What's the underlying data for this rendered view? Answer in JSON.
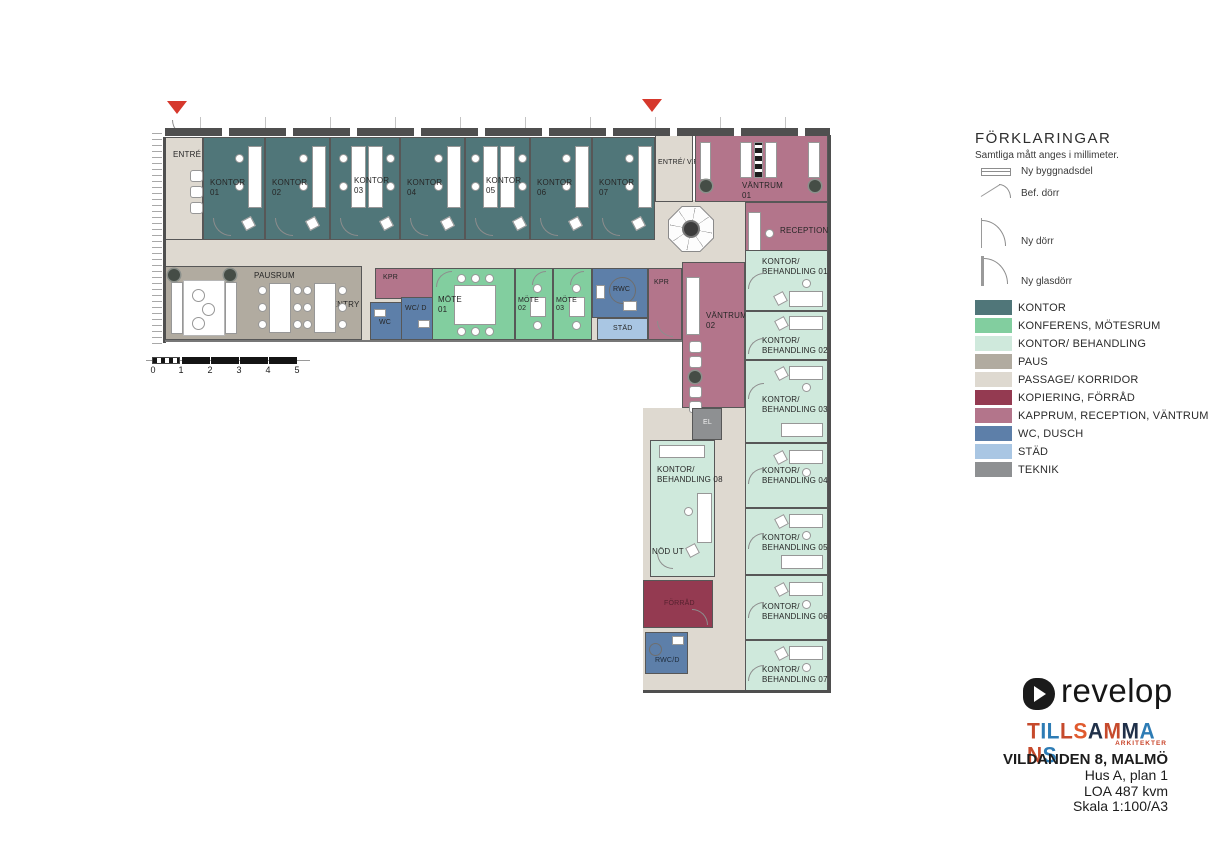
{
  "palette": {
    "kontor": "#507679",
    "konferens": "#82ce9f",
    "behandling": "#cfe9dc",
    "paus": "#b1aba0",
    "passage": "#ded9d0",
    "kopiering": "#943a51",
    "kapprum": "#b3758b",
    "wc": "#5d7fa9",
    "stad": "#a9c6e3",
    "teknik": "#8e9092",
    "accent": "#d6382c"
  },
  "legend": {
    "title": "FÖRKLARINGAR",
    "subtitle": "Samtliga mått anges i millimeter.",
    "symbols": [
      {
        "name": "new-building-part",
        "label": "Ny byggnadsdel"
      },
      {
        "name": "existing-door",
        "label": "Bef. dörr"
      },
      {
        "name": "new-door",
        "label": "Ny dörr"
      },
      {
        "name": "new-glass-door",
        "label": "Ny glasdörr"
      }
    ],
    "colors": [
      {
        "label": "KONTOR",
        "color": "#507679"
      },
      {
        "label": "KONFERENS, MÖTESRUM",
        "color": "#82ce9f"
      },
      {
        "label": "KONTOR/ BEHANDLING",
        "color": "#cfe9dc"
      },
      {
        "label": "PAUS",
        "color": "#b1aba0"
      },
      {
        "label": "PASSAGE/ KORRIDOR",
        "color": "#ded9d0"
      },
      {
        "label": "KOPIERING, FÖRRÅD",
        "color": "#943a51"
      },
      {
        "label": "KAPPRUM, RECEPTION, VÄNTRUM",
        "color": "#b3758b"
      },
      {
        "label": "WC, DUSCH",
        "color": "#5d7fa9"
      },
      {
        "label": "STÄD",
        "color": "#a9c6e3"
      },
      {
        "label": "TEKNIK",
        "color": "#8e9092"
      }
    ]
  },
  "titleblock": {
    "brand": "revelop",
    "studio_letters": [
      {
        "ch": "T",
        "c": "#c64a2c"
      },
      {
        "ch": "I",
        "c": "#2d7cb5"
      },
      {
        "ch": "L",
        "c": "#2d7cb5"
      },
      {
        "ch": "L",
        "c": "#c64a2c"
      },
      {
        "ch": "S",
        "c": "#e05a2e"
      },
      {
        "ch": "A",
        "c": "#203049"
      },
      {
        "ch": "M",
        "c": "#c64a2c"
      },
      {
        "ch": "M",
        "c": "#203049"
      },
      {
        "ch": "A",
        "c": "#2d7cb5"
      },
      {
        "ch": "N",
        "c": "#c64a2c"
      },
      {
        "ch": "S",
        "c": "#2d7cb5"
      }
    ],
    "studio_sub": "ARKITEKTER",
    "project": "VILDANDEN 8, MALMÖ",
    "line2": "Hus A, plan 1",
    "line3": "LOA 487 kvm",
    "line4": "Skala 1:100/A3"
  },
  "plan": {
    "scalebar": {
      "ticks": [
        "0",
        "1",
        "2",
        "3",
        "4",
        "5"
      ]
    },
    "rooms": {
      "entre": {
        "label": "ENTRÉ"
      },
      "entre_vf": {
        "label": "ENTRÉ/ V.F"
      },
      "kontor": [
        {
          "name": "KONTOR",
          "num": "01"
        },
        {
          "name": "KONTOR",
          "num": "02"
        },
        {
          "name": "KONTOR",
          "num": "03"
        },
        {
          "name": "KONTOR",
          "num": "04"
        },
        {
          "name": "KONTOR",
          "num": "05"
        },
        {
          "name": "KONTOR",
          "num": "06"
        },
        {
          "name": "KONTOR",
          "num": "07"
        }
      ],
      "vantrum01": {
        "name": "VÄNTRUM",
        "num": "01"
      },
      "reception": {
        "label": "RECEPTION"
      },
      "pausrum": {
        "label": "PAUSRUM"
      },
      "pentry": {
        "label": "PENTRY"
      },
      "kpr_a": {
        "label": "KPR"
      },
      "wc": {
        "label": "WC"
      },
      "wcd": {
        "label": "WC/ D"
      },
      "mote": [
        {
          "name": "MÖTE",
          "num": "01"
        },
        {
          "name": "MÖTE",
          "num": "02"
        },
        {
          "name": "MÖTE",
          "num": "03"
        }
      ],
      "rwc": {
        "label": "RWC"
      },
      "stad": {
        "label": "STÄD"
      },
      "kpr_b": {
        "label": "KPR"
      },
      "vantrum02": {
        "name": "VÄNTRUM",
        "num": "02"
      },
      "el": {
        "label": "EL"
      },
      "behandling": [
        {
          "l1": "KONTOR/",
          "l2": "BEHANDLING 01"
        },
        {
          "l1": "KONTOR/",
          "l2": "BEHANDLING 02"
        },
        {
          "l1": "KONTOR/",
          "l2": "BEHANDLING 03"
        },
        {
          "l1": "KONTOR/",
          "l2": "BEHANDLING 04"
        },
        {
          "l1": "KONTOR/",
          "l2": "BEHANDLING 05"
        },
        {
          "l1": "KONTOR/",
          "l2": "BEHANDLING 06"
        },
        {
          "l1": "KONTOR/",
          "l2": "BEHANDLING 07"
        }
      ],
      "behandling08": {
        "l1": "KONTOR/",
        "l2": "BEHANDLING 08"
      },
      "nodut": {
        "label": "NÖD UT"
      },
      "forrad": {
        "label": "FÖRRÅD"
      },
      "rwcd": {
        "label": "RWC/D"
      }
    }
  }
}
